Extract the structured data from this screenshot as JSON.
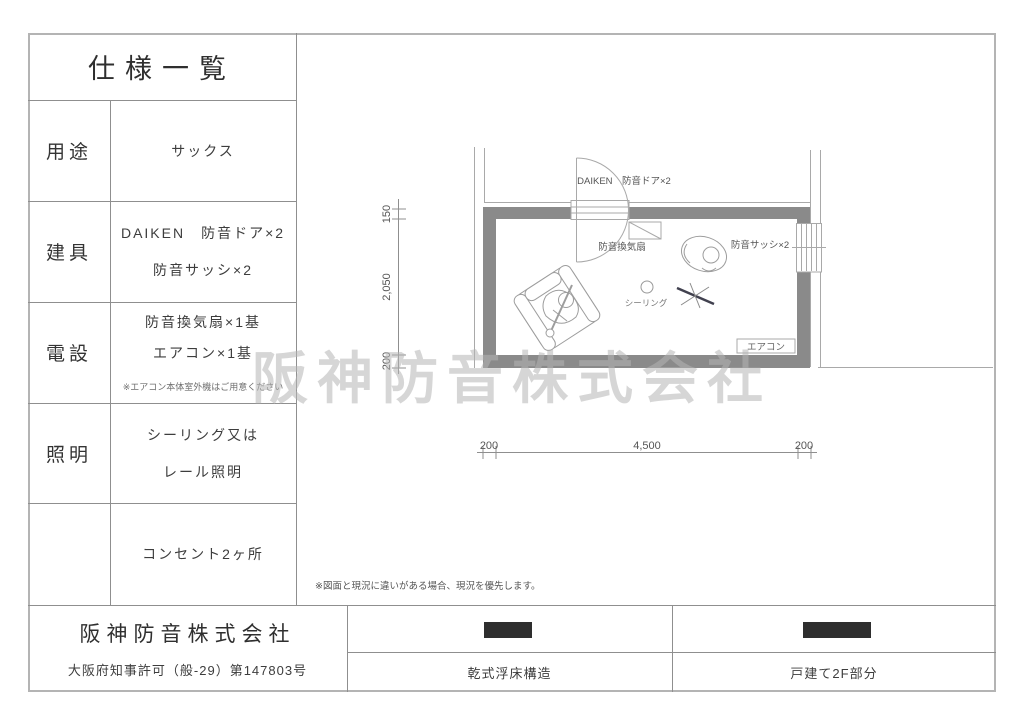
{
  "sheet": {
    "title": "仕様一覧",
    "rows": [
      {
        "label": "用途",
        "line1": "サックス",
        "line2": "",
        "note": ""
      },
      {
        "label": "建具",
        "line1": "DAIKEN　防音ドア×2",
        "line2": "防音サッシ×2",
        "note": ""
      },
      {
        "label": "電設",
        "line1": "防音換気扇×1基",
        "line2": "エアコン×1基",
        "note": "※エアコン本体室外機はご用意ください"
      },
      {
        "label": "照明",
        "line1": "シーリング又は",
        "line2": "レール照明",
        "note": ""
      },
      {
        "label": "",
        "line1": "コンセント2ヶ所",
        "line2": "",
        "note": ""
      }
    ]
  },
  "footer": {
    "company": "阪神防音株式会社",
    "license": "大阪府知事許可（般-29）第147803号",
    "construction_label": "乾式浮床構造",
    "location_label": "戸建て2F部分"
  },
  "plan": {
    "watermark": "阪神防音株式会社",
    "note": "※図面と現況に違いがある場合、現況を優先します。",
    "labels": {
      "door": "DAIKEN　防音ドア×2",
      "fan": "防音換気扇",
      "sash": "防音サッシ×2",
      "ceiling": "シーリング",
      "aircon": "エアコン"
    },
    "dims": {
      "h0": "200",
      "h1": "4,500",
      "h2": "200",
      "v0": "150",
      "v1": "2,050",
      "v2": "200"
    }
  },
  "colors": {
    "wall": "#8a8a8a",
    "thin_line": "#a9a9a9",
    "table_line": "#8f8f8f",
    "redaction": "#2e2e2e",
    "watermark": "#b5b5b5"
  }
}
